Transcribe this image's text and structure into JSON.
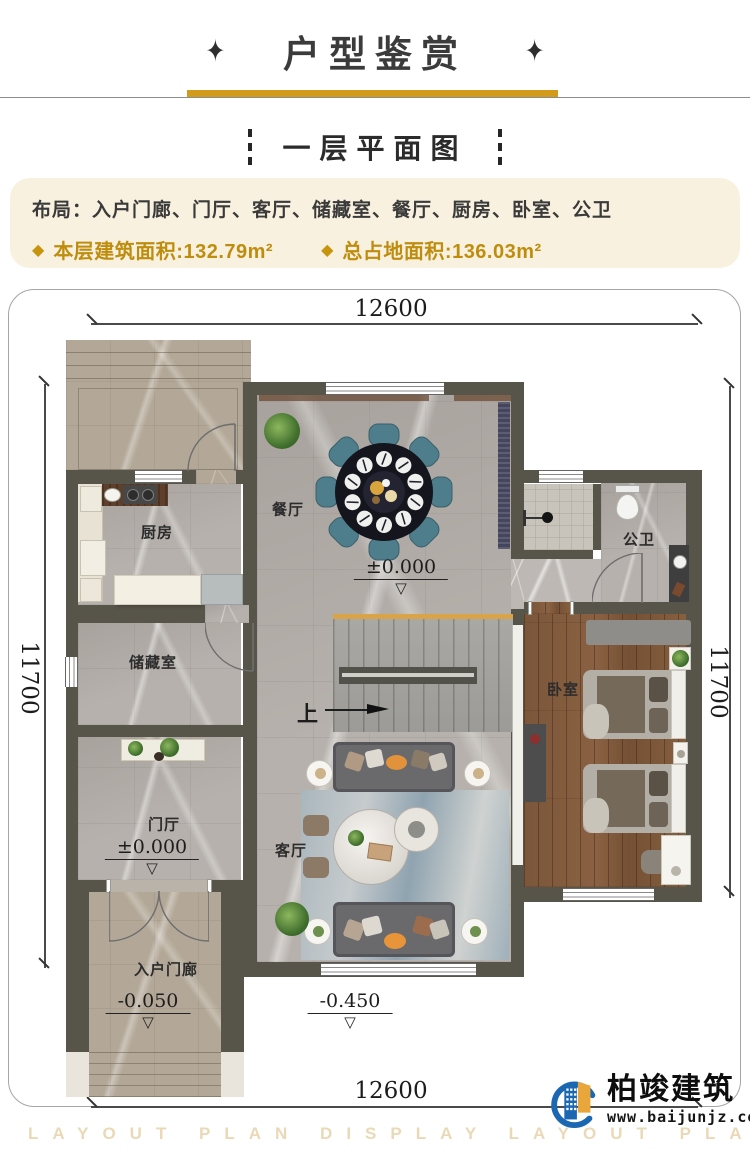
{
  "header": {
    "ornament_left": "✦",
    "title": "户型鉴赏",
    "ornament_right": "✦"
  },
  "subtitle": {
    "text": "一层平面图"
  },
  "info": {
    "layout_label": "布局：",
    "layout_value": "入户门廊、门厅、客厅、储藏室、餐厅、厨房、卧室、公卫",
    "bullet": "◆",
    "area_floor": "本层建筑面积:132.79m²",
    "area_total": "总占地面积:136.03m²"
  },
  "plan": {
    "dims": {
      "top": "12600",
      "bottom": "12600",
      "left": "11700",
      "right": "11700"
    },
    "rooms": {
      "dining": "餐厅",
      "kitchen": "厨房",
      "bath": "公卫",
      "storage": "储藏室",
      "bedroom": "卧室",
      "foyer": "门厅",
      "living": "客厅",
      "porch": "入户门廊"
    },
    "elevations": {
      "dining": "±0.000",
      "foyer": "±0.000",
      "porch": "-0.050",
      "outside": "-0.450",
      "triangle": "▽"
    },
    "stair_up": "上"
  },
  "footer": {
    "watermark": "LAYOUT PLAN DISPLAY LAYOUT PLAN DISPLAY",
    "logo_name": "柏竣建筑",
    "logo_url": "www.baijunjz.com"
  },
  "colors": {
    "gold": "#d29b19",
    "wall": "#57554a",
    "gold_text": "#bf8d0e"
  }
}
